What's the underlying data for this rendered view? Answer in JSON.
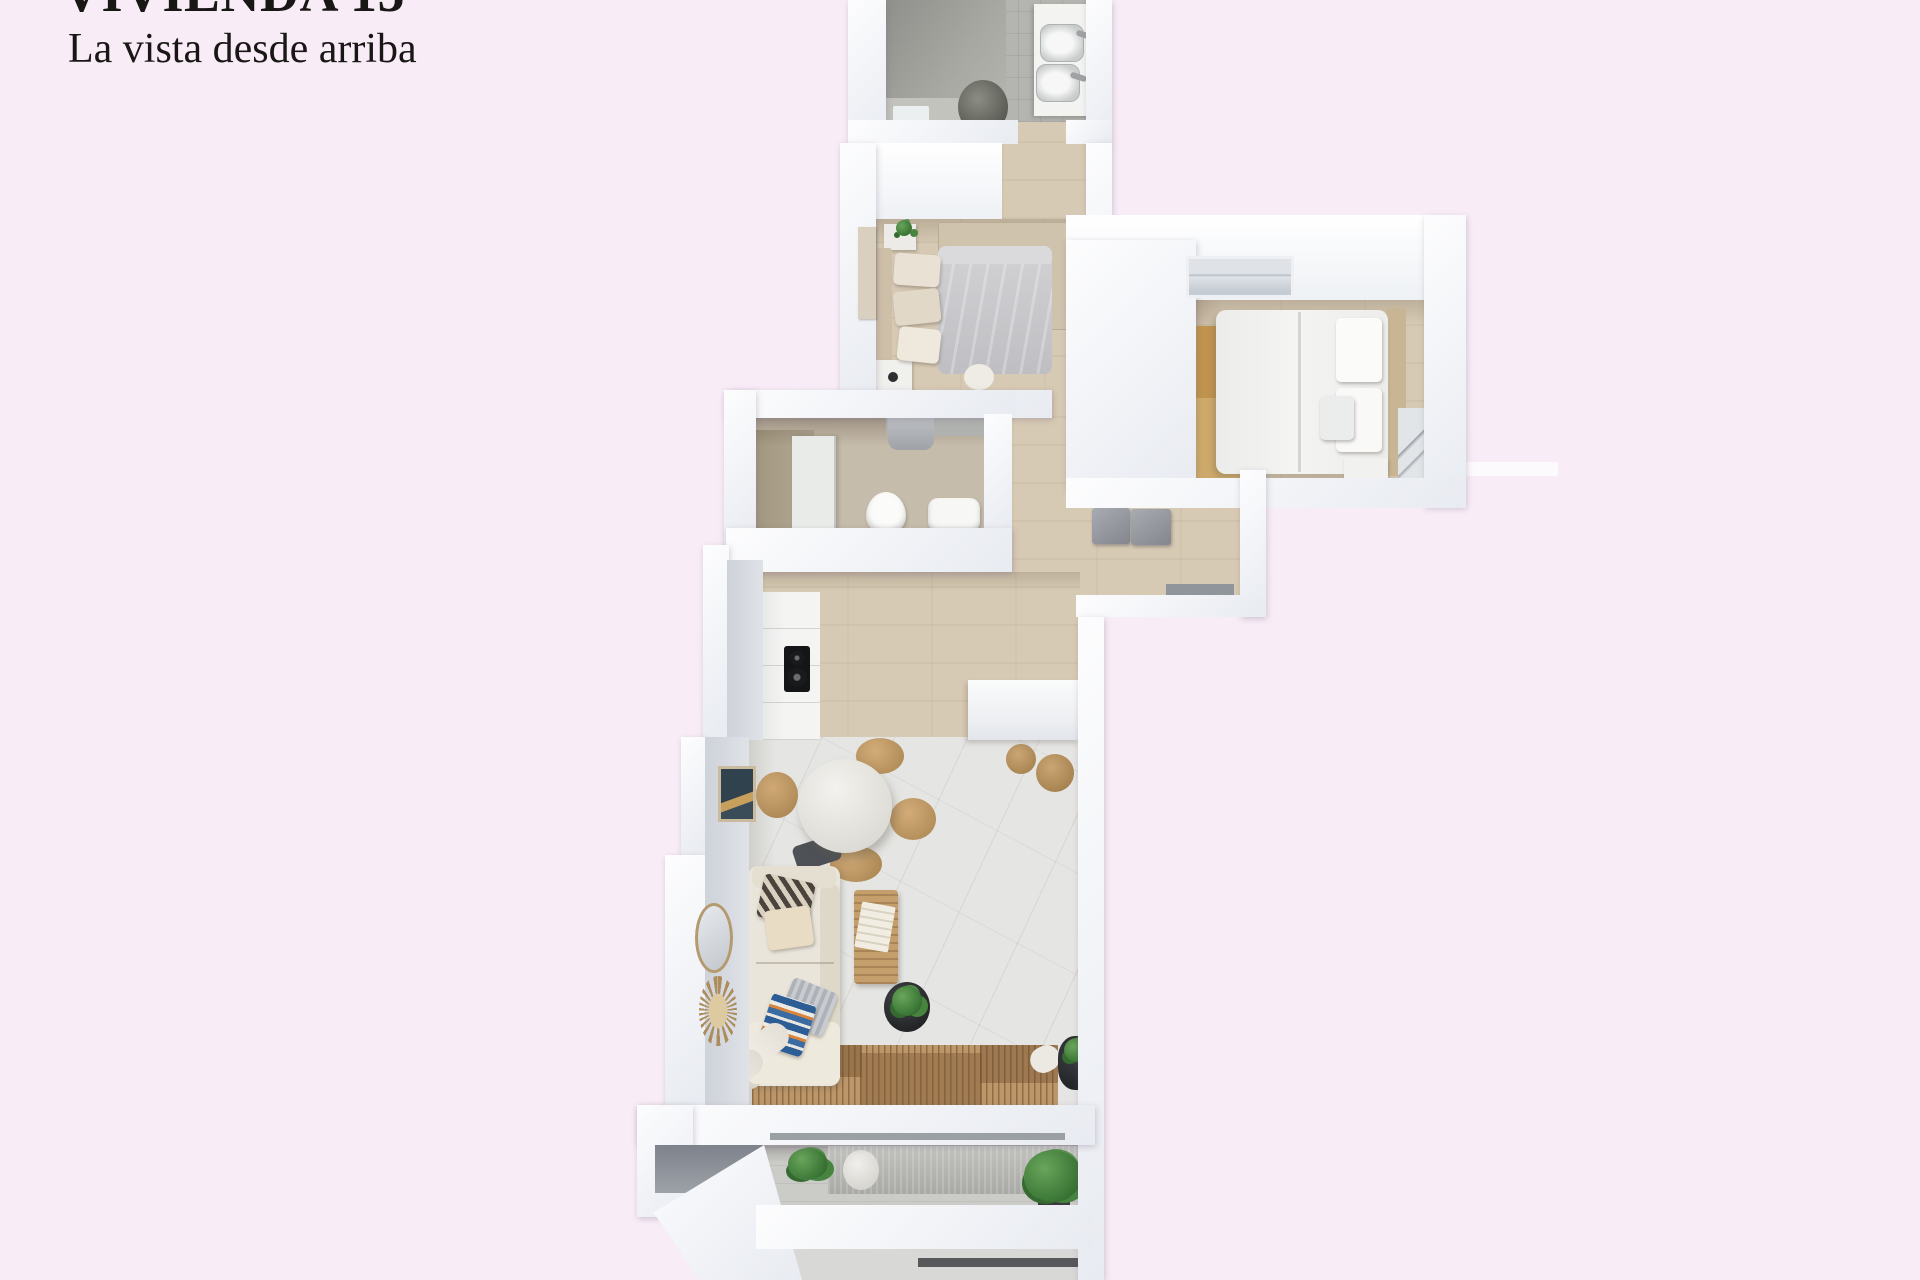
{
  "header": {
    "title": "VIVIENDA 15",
    "subtitle": "La vista desde arriba"
  },
  "colors": {
    "background": "#f8edf7",
    "text": "#191715",
    "wall": "#f1f3f7",
    "wood_floor": "#d7cab4",
    "marble_floor": "#e5e5e3",
    "bathroom_tile": "#b4b5b0",
    "terrace_floor": "#cbcbc8",
    "gold_rug": "#c0944f",
    "plant_green": "#3e7a38"
  }
}
